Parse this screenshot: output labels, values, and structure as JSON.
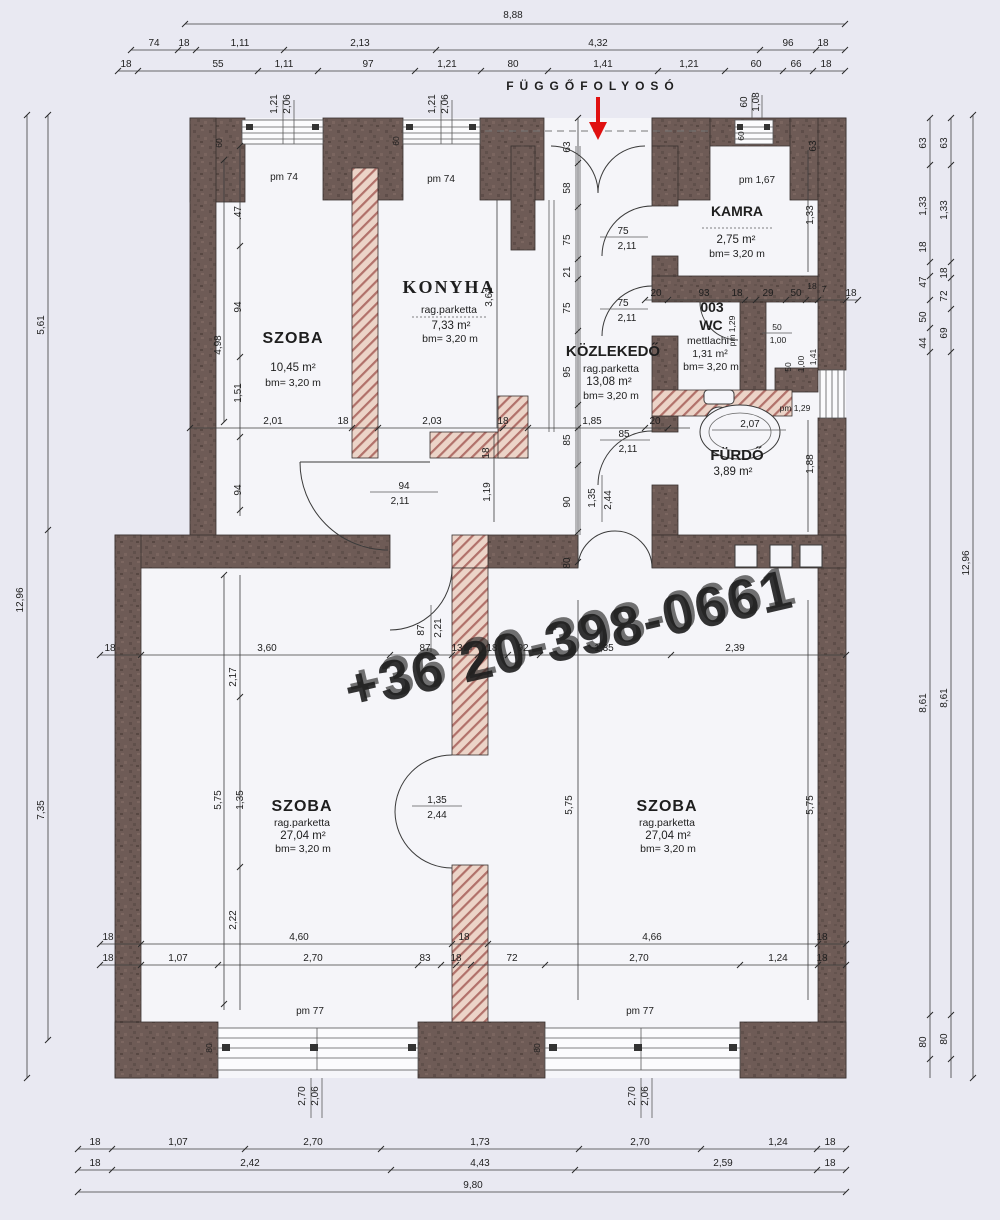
{
  "plan": {
    "corridor_title": "FÜGGŐFOLYOSÓ",
    "watermark": "+36 20-398-0661",
    "rooms": {
      "szoba1": {
        "name": "SZOBA",
        "area": "10,45 m²",
        "height": "bm= 3,20 m"
      },
      "konyha": {
        "name": "KONYHA",
        "floor": "rag.parketta",
        "area": "7,33 m²",
        "height": "bm= 3,20 m"
      },
      "kamra": {
        "name": "KAMRA",
        "area": "2,75 m²",
        "height": "bm= 3,20 m"
      },
      "kozlekedo": {
        "name": "KÖZLEKEDŐ",
        "floor": "rag.parketta",
        "area": "13,08 m²",
        "height": "bm= 3,20 m"
      },
      "wc": {
        "number": "003",
        "name": "WC",
        "floor": "mettlachi",
        "area": "1,31 m²",
        "height": "bm= 3,20 m"
      },
      "furdo": {
        "name": "FÜRDŐ",
        "area": "3,89 m²"
      },
      "szoba2": {
        "name": "SZOBA",
        "floor": "rag.parketta",
        "area": "27,04 m²",
        "height": "bm= 3,20 m"
      },
      "szoba3": {
        "name": "SZOBA",
        "floor": "rag.parketta",
        "area": "27,04 m²",
        "height": "bm= 3,20 m"
      }
    },
    "dims": {
      "top1": [
        "8,88"
      ],
      "top2": [
        "74",
        "18",
        "1,11",
        "2,13",
        "4,32",
        "96",
        "18"
      ],
      "top3": [
        "18",
        "55",
        "1,11",
        "97",
        "1,21",
        "80",
        "1,41",
        "1,21",
        "60",
        "66",
        "18"
      ],
      "bottom1": [
        "18",
        "1,07",
        "2,70",
        "1,73",
        "2,70",
        "1,24",
        "18"
      ],
      "bottom2": [
        "18",
        "2,42",
        "4,43",
        "2,59",
        "18"
      ],
      "bottom3": [
        "9,80"
      ],
      "left": [
        "12,96",
        "5,61",
        "7,35"
      ],
      "right1": [
        "63",
        "1,33",
        "18",
        "47",
        "50",
        "44",
        "8,61",
        "80"
      ],
      "right2": [
        "63",
        "1,33",
        "18",
        "72",
        "69",
        "8,61",
        "80"
      ],
      "right3": [
        "12,96"
      ],
      "mid_row": [
        "18",
        "3,60",
        "87",
        "13",
        "18",
        "92",
        "1,35",
        "2,39"
      ],
      "room_row1": [
        "2,01",
        "18",
        "2,03",
        "18",
        "1,85",
        "20"
      ],
      "wc_row": [
        "20",
        "93",
        "18",
        "29",
        "50",
        "18",
        "7",
        "18"
      ],
      "b_row1": [
        "18",
        "4,60",
        "18",
        "4,66",
        "18"
      ],
      "b_row2": [
        "18",
        "1,07",
        "2,70",
        "83",
        "18",
        "72",
        "2,70",
        "1,24",
        "18"
      ],
      "left_chain": [
        ".47",
        "94",
        "4,98",
        "1,51",
        "94"
      ],
      "left_chain2": [
        "2,17",
        "2,22",
        "5,75",
        "1,35"
      ],
      "szoba_chain": [
        "5,75",
        "5,75"
      ],
      "corridor_chain": [
        "63",
        "58",
        "75",
        "21",
        "75",
        "95",
        "85",
        "90",
        "80"
      ],
      "right_chain": [
        "1,33",
        "3,61",
        "1,19",
        "18",
        "1,88",
        "63"
      ],
      "wc_dims": [
        "50",
        "1,00",
        "pm 1,29",
        "50",
        "1,00",
        "1,41",
        "2,07",
        "pm 1,29"
      ]
    },
    "doors": {
      "d75a": [
        "75",
        "2,11"
      ],
      "d75b": [
        "75",
        "2,11"
      ],
      "d85": [
        "85",
        "2,11"
      ],
      "d94": [
        "94",
        "2,11"
      ],
      "d87": [
        "87",
        "2,21"
      ],
      "d135a": [
        "1,35",
        "2,44"
      ],
      "d135b": [
        "1,35",
        "2,44"
      ]
    },
    "windows": {
      "w1": [
        "1,21",
        "2,06",
        "pm 74"
      ],
      "w2": [
        "1,21",
        "2,06",
        "pm 74"
      ],
      "w3": [
        "60",
        "1,08",
        "pm 1,67"
      ],
      "w4": [
        "2,70",
        "2,06",
        "pm 77"
      ],
      "w5": [
        "2,70",
        "2,06",
        "pm 77"
      ],
      "jambs": [
        "60",
        "60",
        "60",
        "80",
        "80"
      ]
    }
  }
}
